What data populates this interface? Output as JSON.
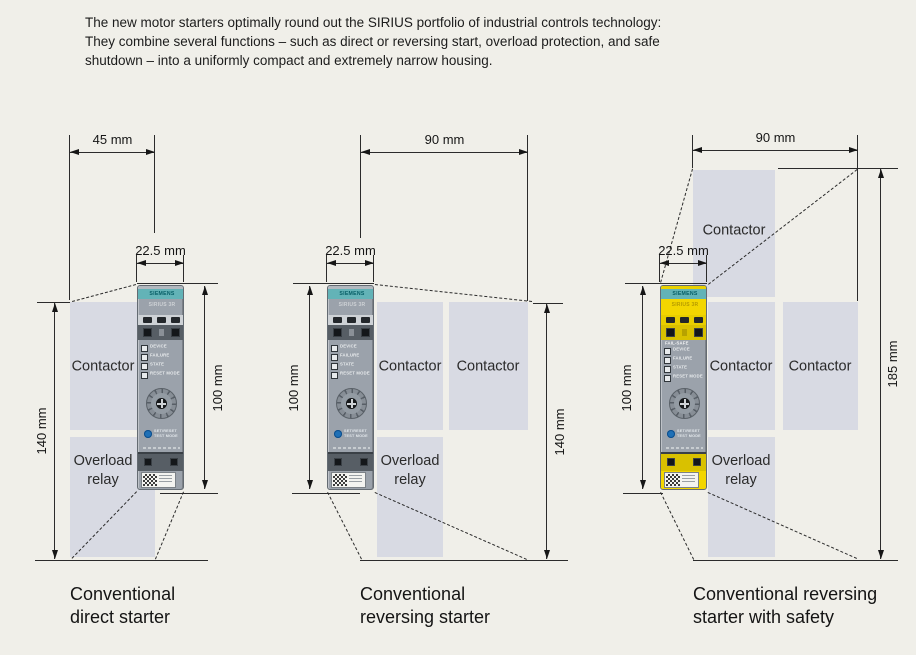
{
  "intro": {
    "text": "The new motor starters optimally round out the SIRIUS portfolio of industrial controls technology:\nThey combine several functions – such as direct or reversing start, overload protection, and safe\nshutdown – into a uniformly compact and extremely narrow housing."
  },
  "colors": {
    "background": "#f0efe9",
    "box_fill": "#d8dae3",
    "siemens_teal": "#63b3b7",
    "siemens_teal_text": "#075e66",
    "safety_yellow": "#f3d600",
    "device_gray": "#9ba2ab",
    "line": "#2b2b2b"
  },
  "device": {
    "brand": "SIEMENS",
    "product_text": "SIRIUS 3R",
    "failsafe_text": "FAIL-SAFE",
    "led_labels": [
      "DEVICE",
      "FAILURE",
      "STATE",
      "RESET MODE"
    ],
    "reset_labels": [
      "SET/RESET",
      "TEST MODE"
    ]
  },
  "diagrams": [
    {
      "id": "conventional-direct-starter",
      "footprint_width": "45 mm",
      "device_width": "22.5 mm",
      "device_height": "100 mm",
      "footprint_height": "140 mm",
      "boxes": [
        {
          "label": "Contactor"
        },
        {
          "label": "Overload\nrelay"
        }
      ],
      "caption": "Conventional\ndirect starter"
    },
    {
      "id": "conventional-reversing-starter",
      "footprint_width": "90 mm",
      "device_width": "22.5 mm",
      "device_height": "100 mm",
      "footprint_height": "140 mm",
      "boxes": [
        {
          "label": "Contactor"
        },
        {
          "label": "Contactor"
        },
        {
          "label": "Overload\nrelay"
        }
      ],
      "caption": "Conventional\nreversing starter"
    },
    {
      "id": "conventional-reversing-starter-with-safety",
      "footprint_width": "90 mm",
      "device_width": "22.5 mm",
      "device_height": "100 mm",
      "footprint_height": "185 mm",
      "boxes": [
        {
          "label": "Contactor"
        },
        {
          "label": "Contactor"
        },
        {
          "label": "Contactor"
        },
        {
          "label": "Overload\nrelay"
        }
      ],
      "caption": "Conventional reversing\nstarter with safety"
    }
  ]
}
